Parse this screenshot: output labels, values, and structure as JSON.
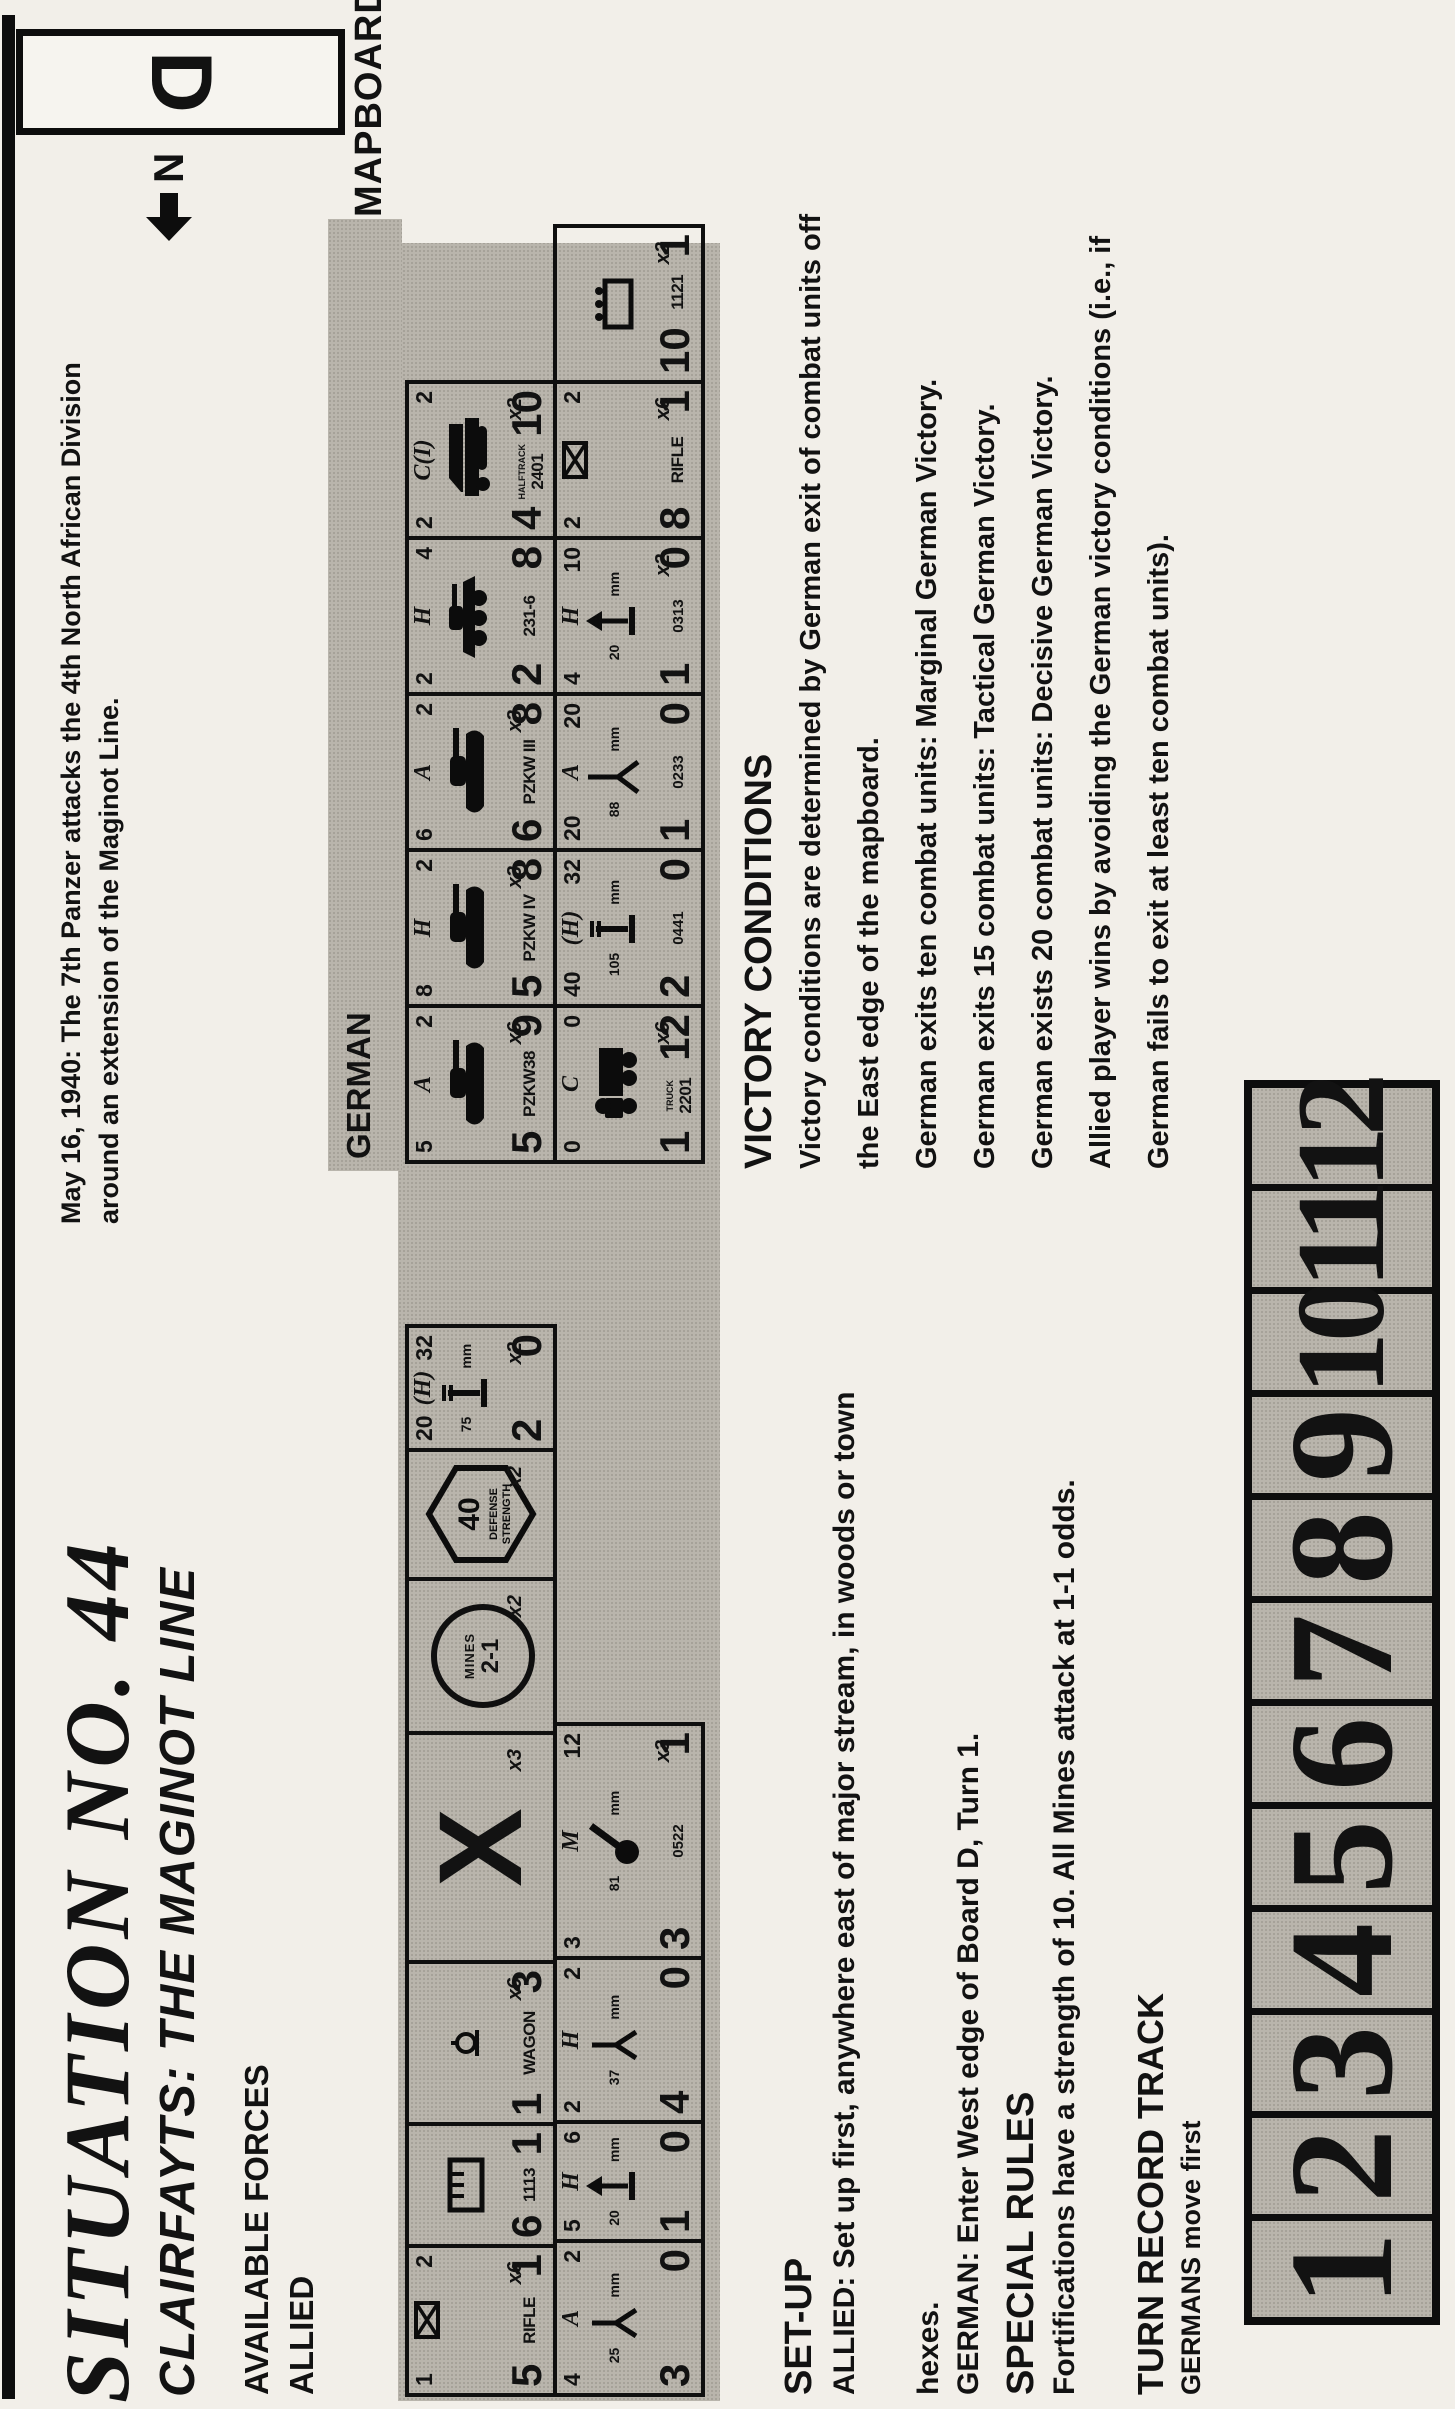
{
  "header": {
    "title": "SITUATION NO. 44",
    "subtitle": "CLAIRFAYTS: THE MAGINOT LINE",
    "intro_bold": "May 16, 1940:",
    "intro_line1": "The 7th Panzer attacks the 4th North African Division",
    "intro_line2": "around an extension of the Maginot Line.",
    "available_forces": "AVAILABLE FORCES",
    "mapboard": "MAPBOARD",
    "board_letter": "D",
    "north_letter": "N"
  },
  "allied": {
    "label": "ALLIED",
    "row1": [
      {
        "t": [
          "1",
          "inf",
          "2"
        ],
        "icon": "",
        "name": "RIFLE",
        "nl": "5",
        "nr": "1",
        "mult": "x6",
        "w": 145
      },
      {
        "t": [
          "",
          "",
          ""
        ],
        "icon": "tickbox",
        "name": "1113",
        "nl": "6",
        "nr": "1",
        "mult": "",
        "w": 118
      },
      {
        "t": [
          "",
          "",
          ""
        ],
        "icon": "hitch",
        "name": "WAGON",
        "nl": "1",
        "nr": "3",
        "mult": "x6",
        "w": 158
      },
      {
        "special": "block",
        "mult": "x3",
        "w": 225
      },
      {
        "special": "mines",
        "mult": "x2",
        "w": 150
      },
      {
        "special": "fort",
        "mult": "x2",
        "w": 125
      },
      {
        "t": [
          "20",
          "(H)",
          "32"
        ],
        "icon": "howitzer",
        "gnum": "75",
        "gmm": "mm",
        "id": "",
        "nl": "2",
        "nr": "0",
        "mult": "x2",
        "w": 120
      }
    ],
    "row2": [
      {
        "t": [
          "4",
          "A",
          "2"
        ],
        "icon": "atgun",
        "gnum": "25",
        "gmm": "mm",
        "id": "",
        "nl": "3",
        "nr": "0",
        "mult": "",
        "w": 150
      },
      {
        "t": [
          "5",
          "H",
          "6"
        ],
        "icon": "aa",
        "gnum": "20",
        "gmm": "mm",
        "id": "",
        "nl": "1",
        "nr": "0",
        "mult": "",
        "w": 115
      },
      {
        "t": [
          "2",
          "H",
          "2"
        ],
        "icon": "atgun",
        "gnum": "37",
        "gmm": "mm",
        "id": "",
        "nl": "4",
        "nr": "0",
        "mult": "",
        "w": 160
      },
      {
        "t": [
          "3",
          "M",
          "12"
        ],
        "icon": "mortar",
        "gnum": "81",
        "gmm": "mm",
        "id": "0522",
        "nl": "3",
        "nr": "1",
        "mult": "x3",
        "w": 230
      }
    ]
  },
  "german": {
    "label": "GERMAN",
    "row1": [
      {
        "t": [
          "5",
          "A",
          "2"
        ],
        "icon": "tank",
        "name": "PZKW38",
        "nl": "5",
        "nr": "9",
        "mult": "x6",
        "w": 152
      },
      {
        "t": [
          "8",
          "H",
          "2"
        ],
        "icon": "tank",
        "name": "PZKW IV",
        "nl": "5",
        "nr": "8",
        "mult": "x3",
        "w": 152
      },
      {
        "t": [
          "6",
          "A",
          "2"
        ],
        "icon": "tank",
        "name": "PZKW III",
        "nl": "6",
        "nr": "8",
        "mult": "x3",
        "w": 152
      },
      {
        "t": [
          "2",
          "H",
          "4"
        ],
        "icon": "armcar",
        "name": "231-6",
        "nl": "2",
        "nr": "8",
        "mult": "",
        "w": 152
      },
      {
        "t": [
          "2",
          "C(I)",
          "2"
        ],
        "icon": "halftrack",
        "tiny": "HALFTRACK",
        "name": "2401",
        "nl": "4",
        "nr": "10",
        "mult": "x2",
        "w": 152
      }
    ],
    "row2": [
      {
        "t": [
          "0",
          "C",
          "0"
        ],
        "icon": "truck",
        "tiny": "TRUCK",
        "name": "2201",
        "nl": "1",
        "nr": "12",
        "mult": "x6",
        "w": 152
      },
      {
        "t": [
          "40",
          "(H)",
          "32"
        ],
        "icon": "howitzer",
        "gnum": "105",
        "gmm": "mm",
        "id": "0441",
        "nl": "2",
        "nr": "0",
        "mult": "",
        "w": 152
      },
      {
        "t": [
          "20",
          "A",
          "20"
        ],
        "icon": "at88",
        "gnum": "88",
        "gmm": "mm",
        "id": "0233",
        "nl": "1",
        "nr": "0",
        "mult": "",
        "w": 152
      },
      {
        "t": [
          "4",
          "H",
          "10"
        ],
        "icon": "aa",
        "gnum": "20",
        "gmm": "mm",
        "id": "0313",
        "nl": "1",
        "nr": "0",
        "mult": "x2",
        "w": 152
      },
      {
        "t": [
          "2",
          "inf",
          "2"
        ],
        "icon": "",
        "name": "RIFLE",
        "nl": "8",
        "nr": "1",
        "mult": "x6",
        "w": 152
      },
      {
        "t": [
          "",
          "",
          ""
        ],
        "icon": "wagonbox",
        "name": "1121",
        "nl": "10",
        "nr": "1",
        "mult": "x2",
        "w": 152
      }
    ]
  },
  "specials": {
    "block_glyph": "X",
    "mines_label": "MINES",
    "mines_odds": "2-1",
    "fort_value": "40",
    "fort_line1": "DEFENSE",
    "fort_line2": "STRENGTH"
  },
  "setup": {
    "heading": "SET-UP",
    "lines": [
      "ALLIED: Set up first, anywhere east of major stream, in woods or town",
      "hexes.",
      "GERMAN: Enter West edge of Board D, Turn 1."
    ]
  },
  "special_rules": {
    "heading": "SPECIAL RULES",
    "lines": [
      "Fortifications have a strength of 10. All Mines attack at 1-1 odds."
    ]
  },
  "victory": {
    "heading": "VICTORY CONDITIONS",
    "lines": [
      "Victory conditions are determined by German exit of combat units off",
      "the East edge of the mapboard.",
      "German exits ten combat units: Marginal German Victory.",
      "German exits 15 combat units: Tactical German Victory.",
      "German exists 20 combat units: Decisive German Victory.",
      "Allied player wins by avoiding the German victory conditions (i.e., if",
      "German fails to exit at least ten combat units)."
    ]
  },
  "turn_track": {
    "heading": "TURN RECORD TRACK",
    "subheading": "GERMANS move first",
    "cells": [
      "1",
      "2",
      "3",
      "4",
      "5",
      "6",
      "7",
      "8",
      "9",
      "10",
      "11",
      "12"
    ]
  }
}
